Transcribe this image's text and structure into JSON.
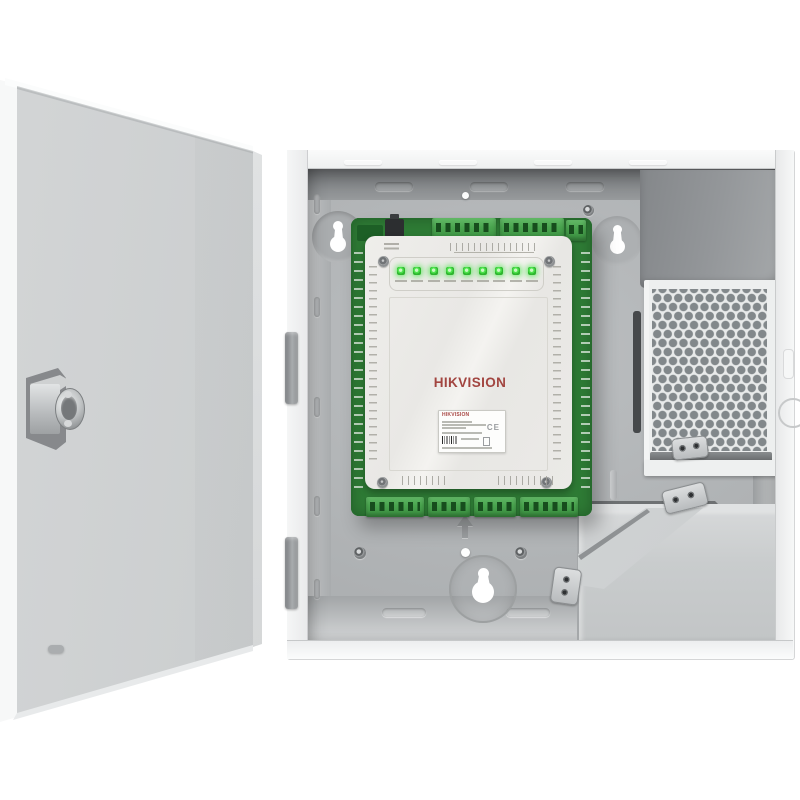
{
  "meta": {
    "type": "product-photo",
    "subject": "Wall-mount metal enclosure with door open showing access controller board, power supply and battery compartment"
  },
  "branding": {
    "logo_text": "HIKVISION",
    "label_brand": "HIKVISION",
    "ce_mark": "CE"
  },
  "controller": {
    "status_leds": {
      "count": 9,
      "state": "all on",
      "color_on": "#3fe03f"
    },
    "terminal_blocks": {
      "top_rows": 3,
      "bottom_rows": 4,
      "color": "#4aa54f"
    }
  },
  "enclosure": {
    "mounting_keyholes": 3,
    "hinges": 2,
    "door_lock": "cam-lock",
    "vent_pattern": "honeycomb"
  },
  "palette": {
    "page_bg": "#ffffff",
    "enclosure_frame": "#f1f2f3",
    "interior_back_panel": "#b3b6b8",
    "interior_top_wall": "#8c8f92",
    "door_face": "#c7cacb",
    "pcb_green": "#2e7b35",
    "terminal_block_green": "#4aa54f",
    "led_green": "#3fe03f",
    "cover_beige": "#ecebe8",
    "logo_red": "#a24540",
    "psu_gray": "#8e9194",
    "vent_face": "#e8eaea",
    "vent_hole": "#82888b",
    "battery_box": "#cdd0d1",
    "metal_bracket": "#d8dadc"
  }
}
